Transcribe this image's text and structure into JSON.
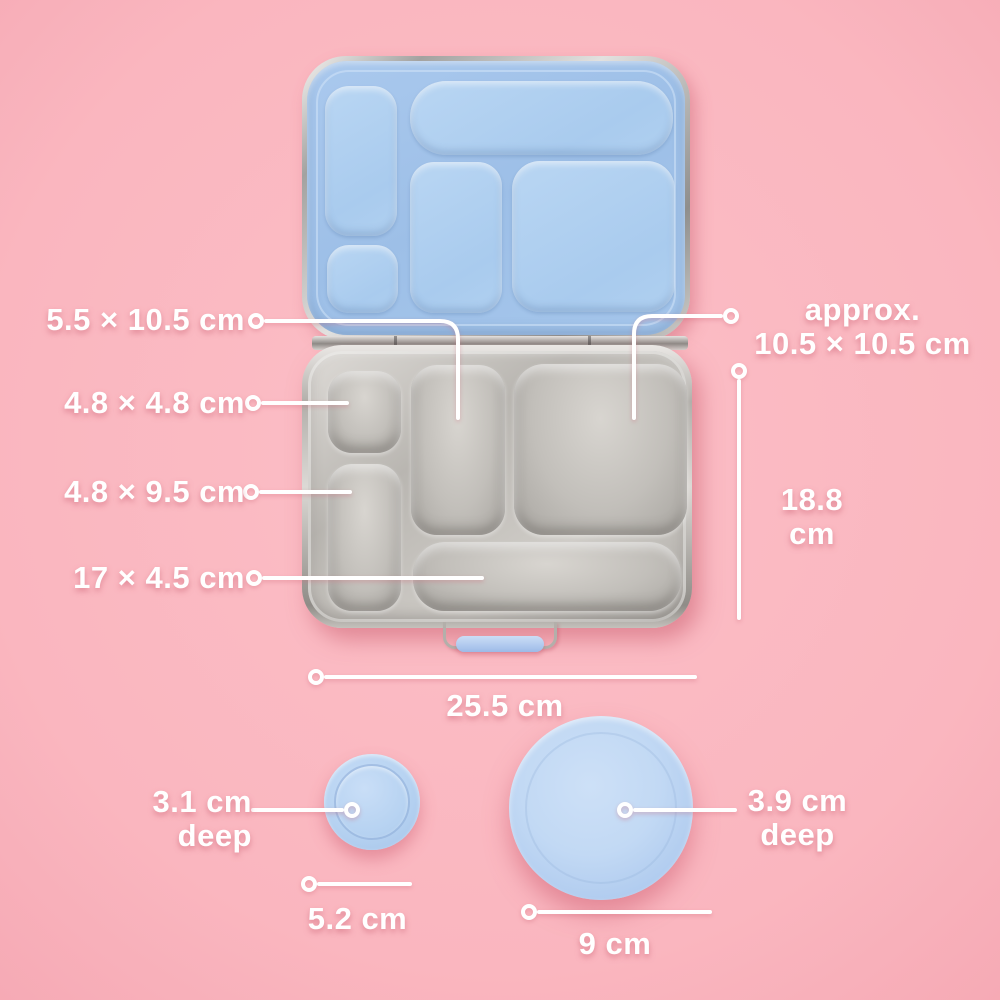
{
  "scene": {
    "description": "Bento lunch box dimensions diagram",
    "colors": {
      "background_pink": "#fab9c1",
      "lid_blue": "#9fc1e8",
      "round_lid_blue": "#b6d2f1",
      "steel_gray": "#c3c0bb",
      "callout_white": "#ffffff"
    }
  },
  "labels": {
    "mid_compartment": "5.5 × 10.5 cm",
    "small_square_compartment": "4.8 × 4.8 cm",
    "left_rect_compartment": "4.8 × 9.5 cm",
    "bottom_long_compartment": "17 × 4.5 cm",
    "large_square_line1": "approx.",
    "large_square_line2": "10.5 × 10.5 cm",
    "box_height_line1": "18.8",
    "box_height_line2": "cm",
    "box_width": "25.5 cm",
    "small_lid_depth_line1": "3.1 cm",
    "small_lid_depth_line2": "deep",
    "small_lid_diameter": "5.2 cm",
    "plate_depth_line1": "3.9 cm",
    "plate_depth_line2": "deep",
    "plate_diameter": "9 cm"
  }
}
